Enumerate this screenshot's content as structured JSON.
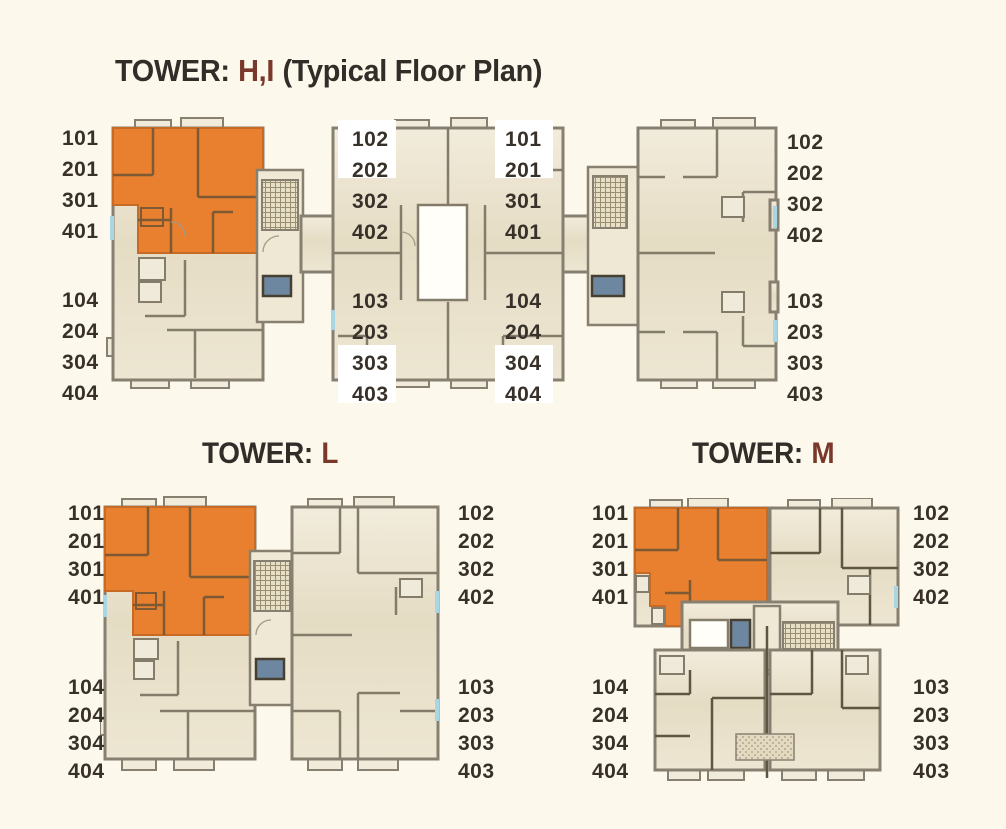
{
  "palette": {
    "background": "#FCF8EB",
    "title_text": "#322D28",
    "title_accent": "#7A382B",
    "unit_label_text": "#38312A",
    "highlight_unit_orange": "#E8802F",
    "building_fill_beige": "#E7DEC7",
    "wall_gray": "#837C6B",
    "elevator_blue": "#6E87A0",
    "window_tick_blue": "#A9D6E5"
  },
  "towers": {
    "hi": {
      "title": {
        "prefix": "TOWER:",
        "accent": "H,I",
        "suffix": "(Typical Floor Plan)"
      },
      "labels": {
        "left_top": [
          "101",
          "201",
          "301",
          "401"
        ],
        "left_bottom": [
          "104",
          "204",
          "304",
          "404"
        ],
        "mid_left_top": [
          "102",
          "202",
          "302",
          "402"
        ],
        "mid_left_bottom": [
          "103",
          "203",
          "303",
          "403"
        ],
        "mid_right_top": [
          "101",
          "201",
          "301",
          "401"
        ],
        "mid_right_bottom": [
          "104",
          "204",
          "304",
          "404"
        ],
        "right_top": [
          "102",
          "202",
          "302",
          "402"
        ],
        "right_bottom": [
          "103",
          "203",
          "303",
          "403"
        ]
      }
    },
    "l": {
      "title": {
        "prefix": "TOWER:",
        "accent": "L",
        "suffix": ""
      },
      "labels": {
        "left_top": [
          "101",
          "201",
          "301",
          "401"
        ],
        "left_bottom": [
          "104",
          "204",
          "304",
          "404"
        ],
        "right_top": [
          "102",
          "202",
          "302",
          "402"
        ],
        "right_bottom": [
          "103",
          "203",
          "303",
          "403"
        ]
      }
    },
    "m": {
      "title": {
        "prefix": "TOWER:",
        "accent": "M",
        "suffix": ""
      },
      "labels": {
        "left_top": [
          "101",
          "201",
          "301",
          "401"
        ],
        "left_bottom": [
          "104",
          "204",
          "304",
          "404"
        ],
        "right_top": [
          "102",
          "202",
          "302",
          "402"
        ],
        "right_bottom": [
          "103",
          "203",
          "303",
          "403"
        ]
      }
    }
  }
}
